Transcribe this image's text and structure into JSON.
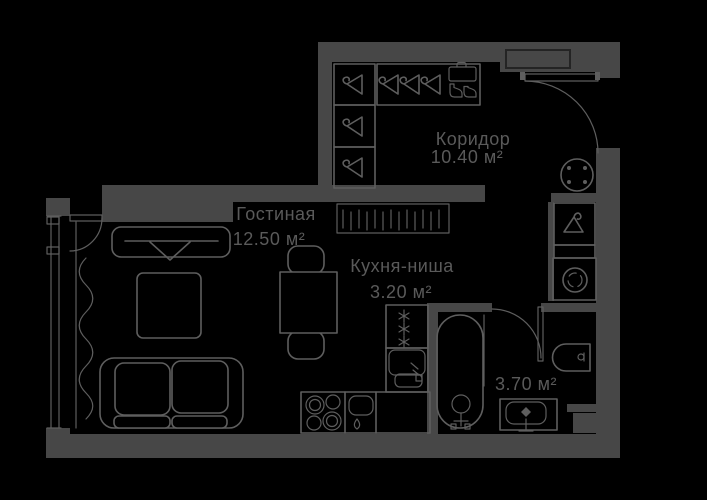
{
  "colors": {
    "background": "#000000",
    "wall": "#474747",
    "line": "#5e5e5e",
    "text": "#5a5a5a",
    "recess": "#242424"
  },
  "plan": {
    "type": "apartment-floor-plan",
    "rooms": [
      {
        "id": "corridor",
        "name": "Коридор",
        "area": "10.40 м²"
      },
      {
        "id": "living",
        "name": "Гостиная",
        "area": "12.50 м²"
      },
      {
        "id": "kitchen",
        "name": "Кухня-ниша",
        "area": "3.20 м²"
      },
      {
        "id": "bathroom",
        "name": "",
        "area": "3.70 м²"
      }
    ]
  },
  "icons": [
    "hanger-icon",
    "suitcase-icon",
    "boots-icon",
    "radiator-icon",
    "stool-icon",
    "washing-machine-icon",
    "fridge-icon",
    "cooktop-icon",
    "kitchen-sink-icon",
    "under-counter-appliance-icon",
    "bathtub-icon",
    "toilet-icon",
    "washbasin-icon",
    "sofa-icon",
    "coffee-table-icon",
    "tv-stand-icon",
    "dining-table-icon",
    "chair-icon",
    "curtain-icon",
    "window-icon",
    "entrance-door-icon",
    "balcony-door-icon",
    "bathroom-door-icon",
    "ventilation-shaft-icon",
    "doormat-icon"
  ]
}
